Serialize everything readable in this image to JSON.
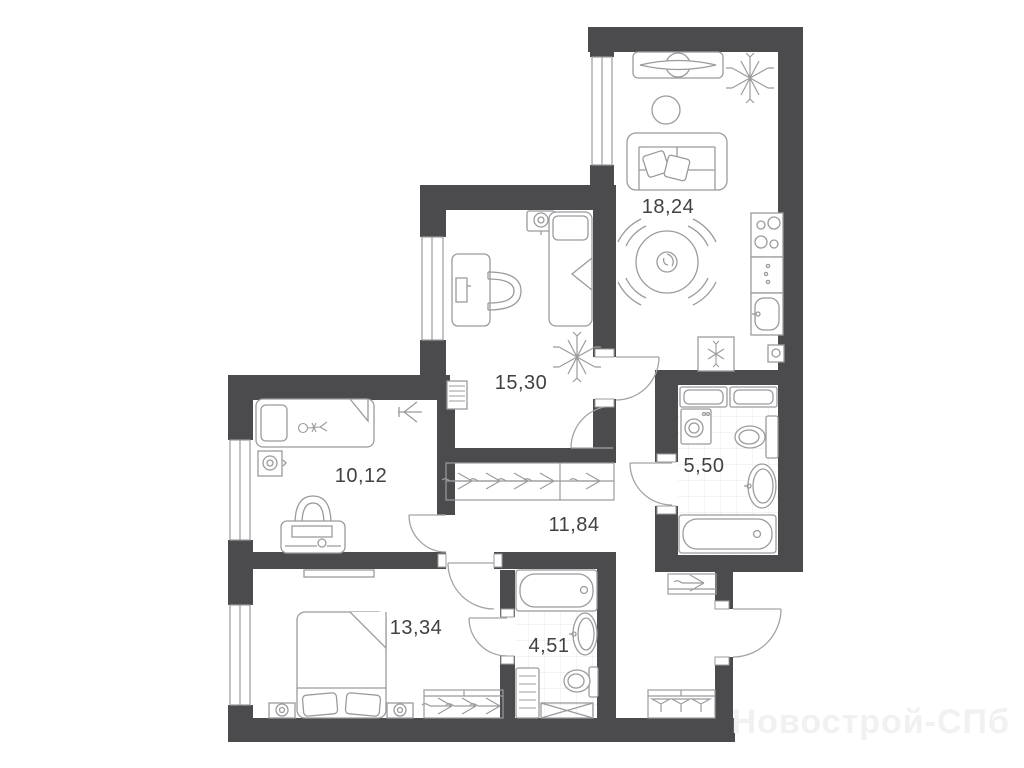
{
  "plan": {
    "type": "apartment-floor-plan",
    "watermark": "Новострой-СПб",
    "rooms": [
      {
        "name": "living-kitchen",
        "label": "18,24",
        "furniture": [
          "tv-console-icon",
          "plant-icon",
          "pouf-icon",
          "sofa-icon",
          "dining-table-icon",
          "chair-icon",
          "stove-icon",
          "kitchen-cabinet-icon",
          "kitchen-sink-icon",
          "fridge-icon"
        ]
      },
      {
        "name": "room-15",
        "label": "15,30",
        "furniture": [
          "wall-fixture-icon",
          "single-bed-icon",
          "desk-icon",
          "desk-chair-icon",
          "radiator-icon",
          "plant-icon"
        ]
      },
      {
        "name": "room-10",
        "label": "10,12",
        "furniture": [
          "kids-bed-icon",
          "child-figure-icon",
          "nightstand-lamp-icon",
          "toy-plane-icon",
          "desk-icon",
          "desk-chair-icon"
        ]
      },
      {
        "name": "bathroom-big",
        "label": "5,50",
        "furniture": [
          "cabinet-icon",
          "washing-machine-icon",
          "toilet-icon",
          "sink-icon",
          "bathtub-icon"
        ]
      },
      {
        "name": "hallway",
        "label": "11,84",
        "furniture": [
          "closet-hangers-icon",
          "entry-closet-icon",
          "entry-wardrobe-icon"
        ]
      },
      {
        "name": "bedroom",
        "label": "13,34",
        "furniture": [
          "shelf-icon",
          "double-bed-icon",
          "pillow-icon",
          "nightstand-lamp-icon",
          "wardrobe-hangers-icon"
        ]
      },
      {
        "name": "bathroom-small",
        "label": "4,51",
        "furniture": [
          "bathtub-icon",
          "sink-icon",
          "toilet-icon",
          "towel-radiator-icon",
          "shower-tray-icon"
        ]
      }
    ],
    "colors": {
      "wall": "#4b4b4d",
      "furniture_line": "#9b9b9e",
      "label_text": "#414144",
      "tile_grid": "#e9e9eb",
      "background": "#ffffff",
      "watermark": "#f1f0f2"
    }
  }
}
